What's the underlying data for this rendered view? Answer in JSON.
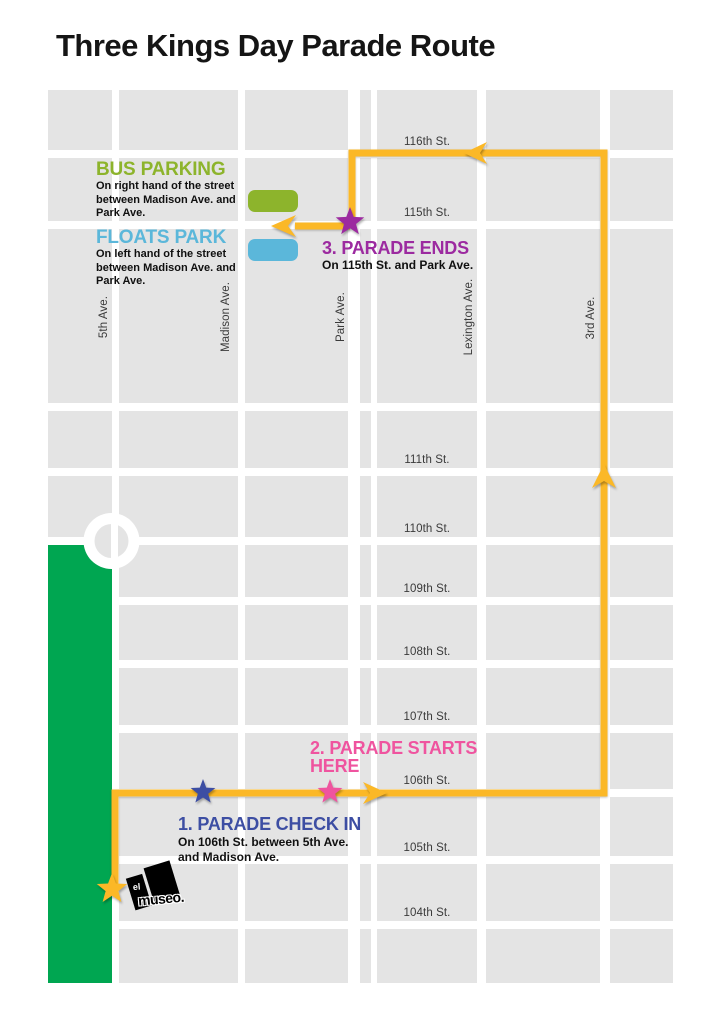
{
  "title": "Three Kings Day Parade Route",
  "colors": {
    "route": "#FBB827",
    "park": "#00A651",
    "block": "#E4E4E4",
    "bus": "#8DB42C",
    "floats": "#5BB7DA",
    "checkin": "#3D4EA3",
    "starts": "#EF549F",
    "ends": "#9C2AA0",
    "logo": "#000000"
  },
  "legend": {
    "bus": {
      "title": "BUS PARKING",
      "line1": "On right hand of the street",
      "line2": "between Madison Ave. and",
      "line3": "Park Ave."
    },
    "floats": {
      "title": "FLOATS PARK",
      "line1": "On left hand of the street",
      "line2": "between Madison Ave. and",
      "line3": "Park Ave."
    }
  },
  "markers": {
    "check_in": {
      "title": "1. PARADE CHECK IN",
      "line1": "On 106th St. between 5th Ave.",
      "line2": "and Madison Ave."
    },
    "start": {
      "line1": "2. PARADE STARTS",
      "line2": "HERE"
    },
    "end": {
      "title": "3. PARADE ENDS",
      "subtitle": "On 115th St. and Park Ave."
    }
  },
  "streets": {
    "s116": "116th St.",
    "s115": "115th St.",
    "s111": "111th St.",
    "s110": "110th St.",
    "s109": "109th St.",
    "s108": "108th St.",
    "s107": "107th St.",
    "s106": "106th St.",
    "s105": "105th St.",
    "s104": "104th St."
  },
  "avenues": {
    "a5": "5th Ave.",
    "madison": "Madison Ave.",
    "park": "Park Ave.",
    "lexington": "Lexington Ave.",
    "a3": "3rd Ave."
  },
  "logo": {
    "el": "el",
    "museo": "museo."
  }
}
